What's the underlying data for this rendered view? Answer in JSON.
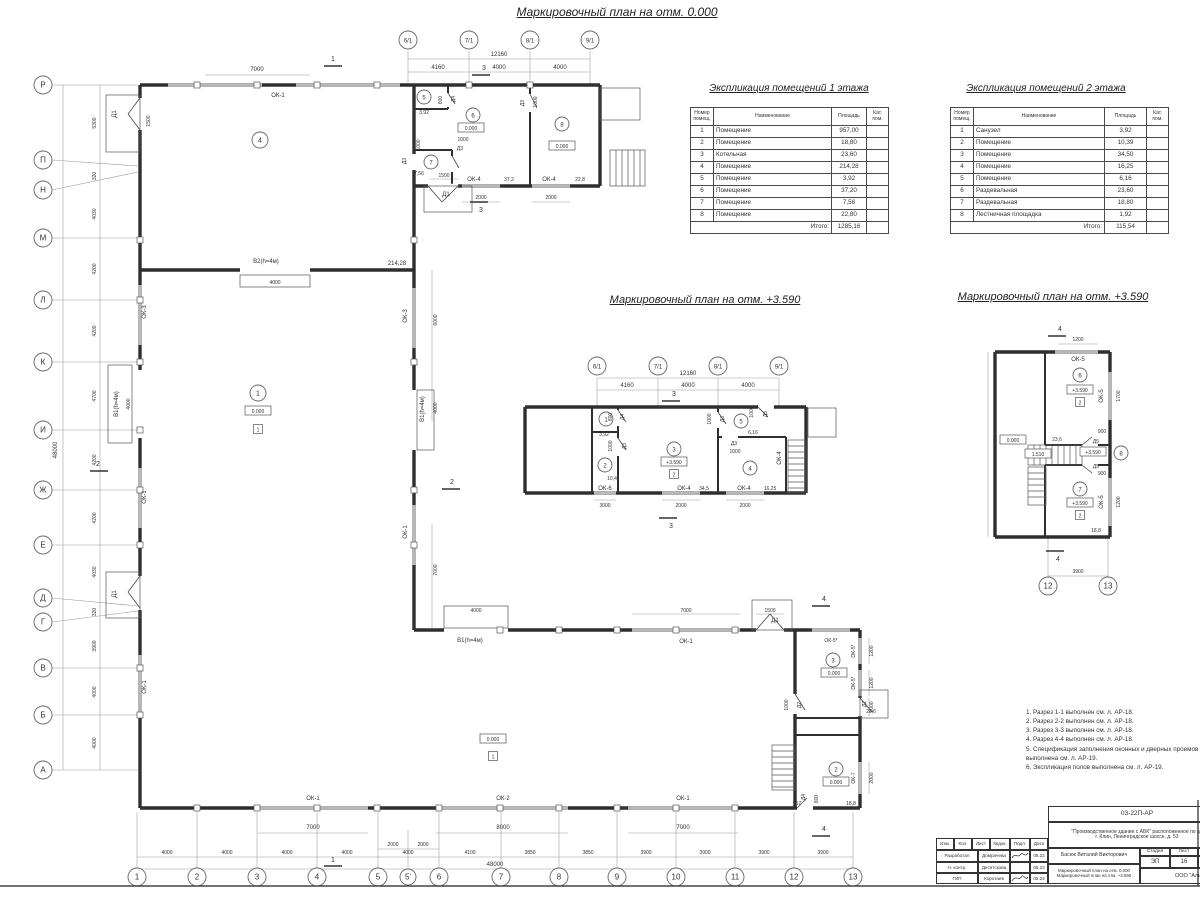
{
  "titles": {
    "plan0": "Маркировочный план на отм. 0.000",
    "plan359": "Маркировочный план на отм. +3.590"
  },
  "tables": {
    "headers": {
      "num": "Номер помещ.",
      "name": "Наименование",
      "area": "Площадь",
      "cat": "Кат. пом.",
      "total": "Итого:"
    },
    "floor1": {
      "title": "Экспликация помещений 1 этажа",
      "rows": [
        {
          "n": "1",
          "name": "Помещение",
          "area": "957,00"
        },
        {
          "n": "2",
          "name": "Помещение",
          "area": "18,80"
        },
        {
          "n": "3",
          "name": "Котельная",
          "area": "23,60"
        },
        {
          "n": "4",
          "name": "Помещение",
          "area": "214,28"
        },
        {
          "n": "5",
          "name": "Помещение",
          "area": "3,92"
        },
        {
          "n": "6",
          "name": "Помещение",
          "area": "37,20"
        },
        {
          "n": "7",
          "name": "Помещение",
          "area": "7,56"
        },
        {
          "n": "8",
          "name": "Помещение",
          "area": "22,80"
        }
      ],
      "total": "1285,16"
    },
    "floor2": {
      "title": "Экспликация помещений 2 этажа",
      "rows": [
        {
          "n": "1",
          "name": "Санузел",
          "area": "3,92"
        },
        {
          "n": "2",
          "name": "Помещение",
          "area": "10,39"
        },
        {
          "n": "3",
          "name": "Помещение",
          "area": "34,50"
        },
        {
          "n": "4",
          "name": "Помещение",
          "area": "16,25"
        },
        {
          "n": "5",
          "name": "Помещение",
          "area": "6,16"
        },
        {
          "n": "6",
          "name": "Раздевальная",
          "area": "23,60"
        },
        {
          "n": "7",
          "name": "Раздевальная",
          "area": "18,80"
        },
        {
          "n": "8",
          "name": "Лестничная площадка",
          "area": "1,92"
        }
      ],
      "total": "115,54"
    }
  },
  "notes": [
    "1. Разрез 1-1 выполнен см. л. АР-18.",
    "2. Разрез 2-2 выполнен см. л. АР-18.",
    "3. Разрез 3-3 выполнен см. л. АР-18.",
    "4. Разрез 4-4 выполнен см. л. АР-18.",
    "5. Спецификация заполнения оконных и дверных проемов выполнена см. л. АР-19.",
    "6. Экспликация полов выполнена см. л. АР-19."
  ],
  "grid": {
    "left": [
      "Р",
      "П",
      "Н",
      "М",
      "Л",
      "К",
      "И",
      "Ж",
      "Е",
      "Д",
      "Г",
      "В",
      "Б",
      "А"
    ],
    "bottom": [
      "1",
      "2",
      "3",
      "4",
      "5",
      "5'",
      "6",
      "7",
      "8",
      "9",
      "10",
      "11",
      "12",
      "13"
    ],
    "top": [
      "6/1",
      "7/1",
      "8/1",
      "9/1"
    ]
  },
  "nums": {
    "n1": "1",
    "n2": "2",
    "n3": "3",
    "n4": "4",
    "n5": "5",
    "n6": "6",
    "n7": "7",
    "n8": "8",
    "n12": "12",
    "n13": "13"
  },
  "dims": {
    "d320": "320",
    "d800": "800",
    "d900": "900",
    "d1000": "1000",
    "d1200": "1200",
    "d1500": "1500",
    "d1700": "1700",
    "d2000": "2000",
    "d3000": "3000",
    "d3850": "3850",
    "d3900": "3900",
    "d4000": "4000",
    "d4030": "4030",
    "d4100": "4100",
    "d4160": "4160",
    "d4200": "4200",
    "d4700": "4700",
    "d5300": "5300",
    "d6000": "6000",
    "d7000": "7000",
    "d8000": "8000",
    "d12160": "12160",
    "d48000": "48000"
  },
  "tags": {
    "ok1": "ОК-1",
    "ok2": "ОК-2",
    "ok3": "ОК-3",
    "ok4": "ОК-4",
    "ok5": "ОК-5",
    "ok5s": "ОК-5*",
    "ok6": "ОК-6",
    "ok7": "ОК-7",
    "d1": "Д1",
    "d2": "Д2",
    "d3": "Д3",
    "d4": "Д4",
    "d5": "Д5",
    "v1": "В1(h=4м)",
    "v2": "В2(h=4м)"
  },
  "areas": {
    "a1": "957",
    "a2": "18,8",
    "a3": "23,6",
    "a4": "214,28",
    "a5": "3,92",
    "a6": "37,2",
    "a7": "7,56",
    "a8": "22,8",
    "m2": "10,4",
    "m3": "34,5",
    "m4": "16,25",
    "m5": "6,16"
  },
  "levels": {
    "zero": "0.000",
    "l359": "+3.590",
    "l151": "1.510"
  },
  "titleblock": {
    "doc": "03-22П-АР",
    "obj1": "\"Производственное здание с АБК\" расположенное по ад",
    "obj2": "г. Клин, Ленинградское шоссе, д. 53",
    "author": "Басюк Виталий Викторович",
    "stage_h": "Стадия",
    "list_h": "Лист",
    "stage": "ЭП",
    "list": "16",
    "company": "ООО \"Аль",
    "cols": {
      "izm": "Изм.",
      "kol": "Кол.",
      "list": "Лист",
      "doc": "№док.",
      "podp": "Подл.",
      "data": "Дата"
    },
    "rows": [
      {
        "role": "Разработал",
        "name": "Домрачева",
        "date": "05.22"
      },
      {
        "role": "Н. контр.",
        "name": "Десятскова",
        "date": "05.22"
      },
      {
        "role": "ГИП",
        "name": "Коротаев",
        "date": "05.22"
      }
    ]
  }
}
